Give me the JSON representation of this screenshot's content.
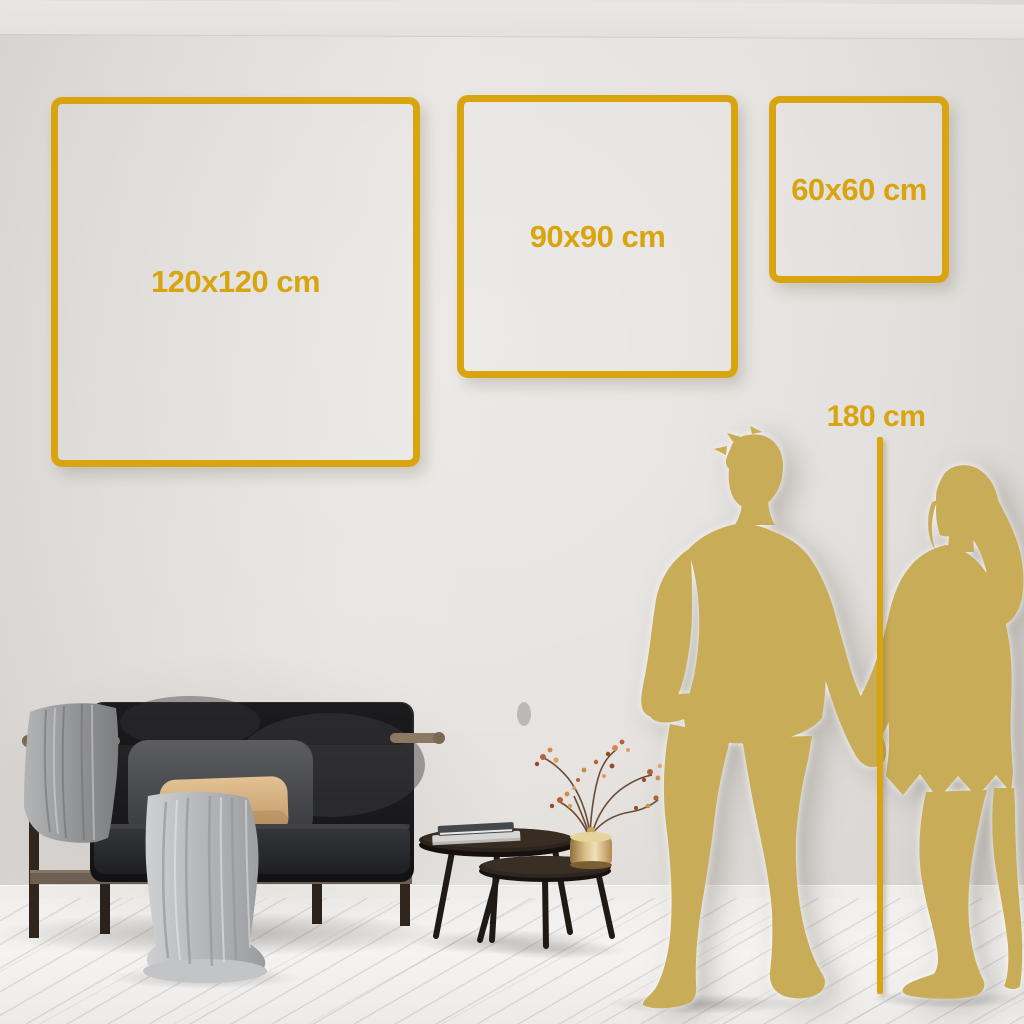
{
  "size_guide": {
    "sizes": [
      {
        "id": "120x120",
        "label": "120x120 cm",
        "width_cm": 120,
        "height_cm": 120
      },
      {
        "id": "90x90",
        "label": "90x90 cm",
        "width_cm": 90,
        "height_cm": 90
      },
      {
        "id": "60x60",
        "label": "60x60 cm",
        "width_cm": 60,
        "height_cm": 60
      }
    ],
    "reference": {
      "label": "180 cm",
      "height_cm": 180
    }
  },
  "colors": {
    "accent_gold": "#d8a511",
    "silhouette_gold": "#c8ac57",
    "wall": "#e6e3e0",
    "floor": "#f1efed",
    "sofa_dark": "#1c1c1f",
    "pillow_tan": "#d9b789",
    "blanket_gray": "#b0b1b3"
  },
  "scene": {
    "items": [
      "sofa",
      "throw-blanket",
      "back-cushion",
      "accent-pillow",
      "nesting-coffee-tables",
      "books",
      "brass-vase",
      "dried-flower-branch",
      "man-silhouette",
      "woman-silhouette",
      "height-ruler"
    ]
  }
}
